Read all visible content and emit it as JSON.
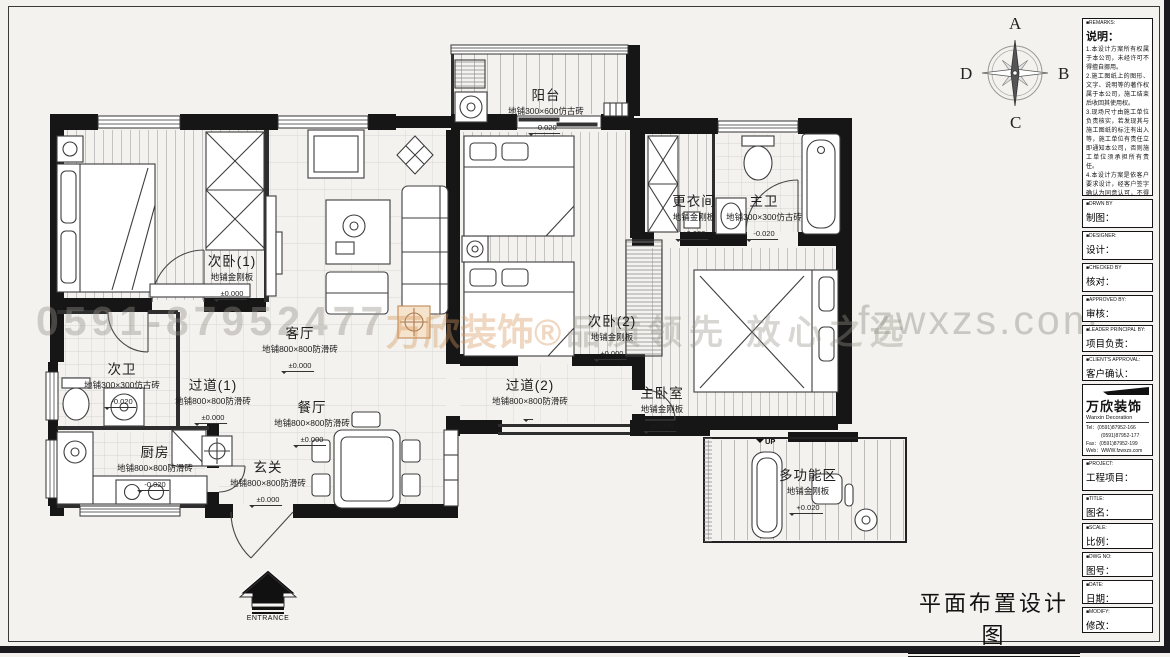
{
  "drawing_title": "平面布置设计图",
  "compass": {
    "top": "A",
    "right": "B",
    "bottom": "C",
    "left": "D"
  },
  "watermark": {
    "phone": "0591-87952477",
    "brand": "万欣装饰®",
    "slogan": "品质领先 放心之选",
    "website": "fzwxzs.com"
  },
  "plan": {
    "entrance_label": "ENTRANCE",
    "up_label": "UP"
  },
  "rooms": [
    {
      "name": "次卧(1)",
      "floor": "地铺金刚板",
      "level": "±0.000"
    },
    {
      "name": "客厅",
      "floor": "地铺800×800防滑砖",
      "level": "±0.000"
    },
    {
      "name": "阳台",
      "floor": "地铺300×600仿古砖",
      "level": "-0.020"
    },
    {
      "name": "次卧(2)",
      "floor": "地铺金刚板",
      "level": "±0.000"
    },
    {
      "name": "更衣间",
      "floor": "地铺金刚板",
      "level": "±0.000"
    },
    {
      "name": "主卫",
      "floor": "地铺300×300仿古砖",
      "level": "-0.020"
    },
    {
      "name": "次卫",
      "floor": "地铺300×300仿古砖",
      "level": "-0.020"
    },
    {
      "name": "过道(1)",
      "floor": "地铺800×800防滑砖",
      "level": "±0.000"
    },
    {
      "name": "餐厅",
      "floor": "地铺800×800防滑砖",
      "level": "±0.000"
    },
    {
      "name": "厨房",
      "floor": "地铺800×800防滑砖",
      "level": "-0.020"
    },
    {
      "name": "玄关",
      "floor": "地铺800×800防滑砖",
      "level": "±0.000"
    },
    {
      "name": "过道(2)",
      "floor": "地铺800×800防滑砖",
      "level": "±0.000"
    },
    {
      "name": "主卧室",
      "floor": "地铺金刚板",
      "level": "±0.000"
    },
    {
      "name": "多功能区",
      "floor": "地铺金刚板",
      "level": "+0.020"
    }
  ],
  "panel": {
    "remarks_en": "■REMARKS:",
    "remarks_title": "说明：",
    "remarks_items": [
      "1.本设计方案所有权属于本公司，未经许可不得擅自挪用。",
      "2.施工图纸上的图形、文字、说明等的著作权属于本公司，施工结束后收回其使用权。",
      "3.现场尺寸由施工单位负责核实，若发现其与施工图纸的标注有出入等，施工单位有责任立即通知本公司，否则施工单位须承担所有责任。",
      "4.本设计方案是依客户要求设计，经客户签字确认为同意认可，不得随意更改。"
    ],
    "fields": [
      {
        "en": "■DRWN BY",
        "zh": "制图："
      },
      {
        "en": "■DESIGNER:",
        "zh": "设计："
      },
      {
        "en": "■CHECKED BY",
        "zh": "核对："
      },
      {
        "en": "■APPROVED BY:",
        "zh": "审核："
      },
      {
        "en": "■LEADER PRINCIPAL BY:",
        "zh": "项目负责："
      },
      {
        "en": "■CLIENT'S APPROVAL:",
        "zh": "客户确认："
      }
    ],
    "company": {
      "logo": "万欣装饰",
      "name_en": "Wanxin Decoration",
      "tel1": "Tel：(0591)87952-166",
      "tel2": "　　　(0591)87952-177",
      "fax": "Fax：(0591)87952-199",
      "web": "Web：WWW.fzwxzs.com"
    },
    "fields2": [
      {
        "en": "■PROJECT:",
        "zh": "工程项目："
      },
      {
        "en": "■TITLE:",
        "zh": "图名："
      },
      {
        "en": "■SCALE:",
        "zh": "比例："
      },
      {
        "en": "■DWG NO:",
        "zh": "图号："
      },
      {
        "en": "■DATE:",
        "zh": "日期："
      },
      {
        "en": "■MODIFY:",
        "zh": "修改："
      }
    ]
  }
}
